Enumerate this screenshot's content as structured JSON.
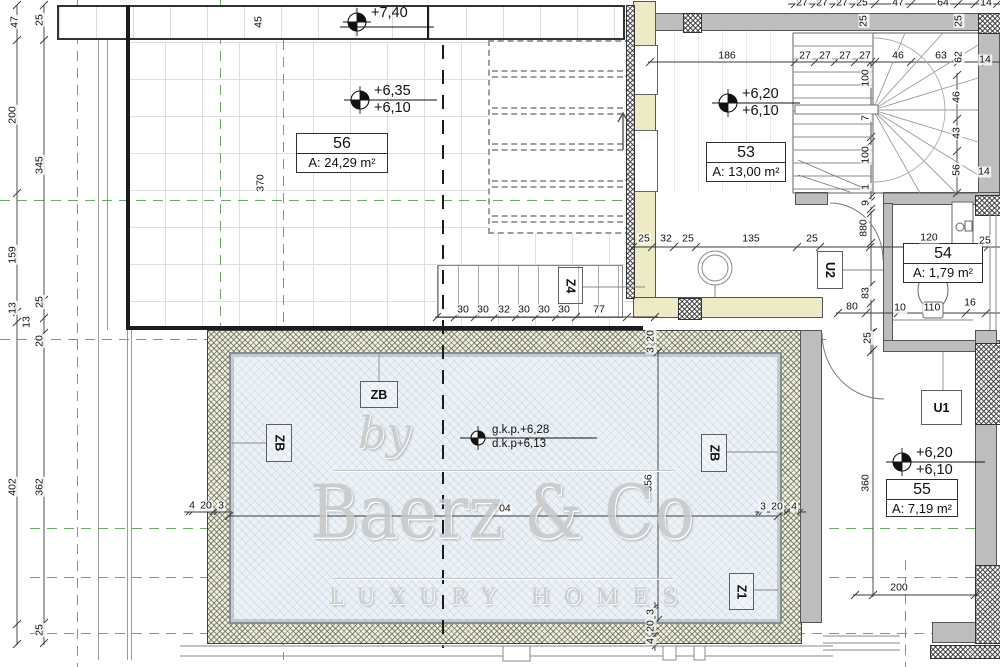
{
  "watermark": {
    "by": "by",
    "brand": "Baerz & Co",
    "tagline": "LUXURY HOMES"
  },
  "rooms": [
    {
      "number": "56",
      "area": "A: 24,29 m²"
    },
    {
      "number": "53",
      "area": "A: 13,00 m²"
    },
    {
      "number": "54",
      "area": "A: 1,79 m²"
    },
    {
      "number": "55",
      "area": "A: 7,19 m²"
    }
  ],
  "zone_labels": [
    {
      "t": "ZB",
      "x": 266,
      "y": 424,
      "w": 26,
      "h": 38,
      "rot": 1
    },
    {
      "t": "ZB",
      "x": 360,
      "y": 381,
      "w": 38,
      "h": 27,
      "rot": 0
    },
    {
      "t": "ZB",
      "x": 701,
      "y": 434,
      "w": 26,
      "h": 38,
      "rot": 1
    },
    {
      "t": "Z4",
      "x": 558,
      "y": 267,
      "w": 25,
      "h": 37,
      "rot": 1
    },
    {
      "t": "Z1",
      "x": 729,
      "y": 573,
      "w": 25,
      "h": 37,
      "rot": 1
    },
    {
      "t": "U1",
      "x": 921,
      "y": 390,
      "w": 41,
      "h": 35,
      "rot": 0
    },
    {
      "t": "U2",
      "x": 817,
      "y": 251,
      "w": 26,
      "h": 38,
      "rot": 1
    }
  ],
  "level_markers": [
    {
      "x": 357,
      "y": 22,
      "small": 0,
      "lines": [
        "+7,40"
      ]
    },
    {
      "x": 360,
      "y": 100,
      "small": 0,
      "lines": [
        "+6,35",
        "+6,10"
      ]
    },
    {
      "x": 728,
      "y": 103,
      "small": 0,
      "lines": [
        "+6,20",
        "+6,10"
      ]
    },
    {
      "x": 902,
      "y": 462,
      "small": 0,
      "lines": [
        "+6,20",
        "+6,10"
      ]
    },
    {
      "x": 478,
      "y": 438,
      "small": 1,
      "lines": [
        "g.k.p.+6,28",
        "d.k.p+6,13"
      ]
    }
  ],
  "dim_labels": [
    {
      "t": "47",
      "x": 15,
      "y": 22,
      "r": 1
    },
    {
      "t": "200",
      "x": 13,
      "y": 115,
      "r": 1
    },
    {
      "t": "159",
      "x": 13,
      "y": 255,
      "r": 1
    },
    {
      "t": "13",
      "x": 13,
      "y": 308,
      "r": 1
    },
    {
      "t": "402",
      "x": 13,
      "y": 487,
      "r": 1
    },
    {
      "t": "25",
      "x": 40,
      "y": 20,
      "r": 1
    },
    {
      "t": "345",
      "x": 40,
      "y": 165,
      "r": 1
    },
    {
      "t": "25",
      "x": 40,
      "y": 302,
      "r": 1
    },
    {
      "t": "13",
      "x": 27,
      "y": 322,
      "r": 1
    },
    {
      "t": "20",
      "x": 40,
      "y": 341,
      "r": 1
    },
    {
      "t": "362",
      "x": 40,
      "y": 487,
      "r": 1
    },
    {
      "t": "25",
      "x": 40,
      "y": 630,
      "r": 1
    },
    {
      "t": "45",
      "x": 259,
      "y": 22,
      "r": 1
    },
    {
      "t": "370",
      "x": 261,
      "y": 183,
      "r": 1
    },
    {
      "t": "27",
      "x": 802,
      "y": 3,
      "r": 0
    },
    {
      "t": "27",
      "x": 822,
      "y": 3,
      "r": 0
    },
    {
      "t": "27",
      "x": 842,
      "y": 3,
      "r": 0
    },
    {
      "t": "25",
      "x": 862,
      "y": 3,
      "r": 0
    },
    {
      "t": "47",
      "x": 898,
      "y": 3,
      "r": 0
    },
    {
      "t": "64",
      "x": 943,
      "y": 3,
      "r": 0
    },
    {
      "t": "14",
      "x": 986,
      "y": 3,
      "r": 0
    },
    {
      "t": "25",
      "x": 864,
      "y": 21,
      "r": 1
    },
    {
      "t": "25",
      "x": 959,
      "y": 21,
      "r": 1
    },
    {
      "t": "186",
      "x": 727,
      "y": 56,
      "r": 0
    },
    {
      "t": "27",
      "x": 805,
      "y": 56,
      "r": 0
    },
    {
      "t": "27",
      "x": 825,
      "y": 56,
      "r": 0
    },
    {
      "t": "27",
      "x": 845,
      "y": 56,
      "r": 0
    },
    {
      "t": "27",
      "x": 865,
      "y": 56,
      "r": 0
    },
    {
      "t": "46",
      "x": 898,
      "y": 56,
      "r": 0
    },
    {
      "t": "63",
      "x": 941,
      "y": 56,
      "r": 0
    },
    {
      "t": "62",
      "x": 959,
      "y": 57,
      "r": 1
    },
    {
      "t": "14",
      "x": 985,
      "y": 60,
      "r": 0
    },
    {
      "t": "100",
      "x": 866,
      "y": 78,
      "r": 1
    },
    {
      "t": "7",
      "x": 866,
      "y": 118,
      "r": 1
    },
    {
      "t": "100",
      "x": 866,
      "y": 155,
      "r": 1
    },
    {
      "t": "1",
      "x": 866,
      "y": 187,
      "r": 1
    },
    {
      "t": "9",
      "x": 866,
      "y": 203,
      "r": 1
    },
    {
      "t": "46",
      "x": 957,
      "y": 97,
      "r": 1
    },
    {
      "t": "43",
      "x": 957,
      "y": 133,
      "r": 1
    },
    {
      "t": "56",
      "x": 957,
      "y": 170,
      "r": 1
    },
    {
      "t": "14",
      "x": 984,
      "y": 172,
      "r": 0
    },
    {
      "t": "880",
      "x": 864,
      "y": 228,
      "r": 1
    },
    {
      "t": "83",
      "x": 866,
      "y": 293,
      "r": 1
    },
    {
      "t": "80",
      "x": 852,
      "y": 307,
      "r": 0
    },
    {
      "t": "10",
      "x": 900,
      "y": 308,
      "r": 0
    },
    {
      "t": "110",
      "x": 932,
      "y": 308,
      "r": 0
    },
    {
      "t": "16",
      "x": 970,
      "y": 303,
      "r": 0
    },
    {
      "t": "25",
      "x": 868,
      "y": 338,
      "r": 1
    },
    {
      "t": "120",
      "x": 929,
      "y": 238,
      "r": 0
    },
    {
      "t": "25",
      "x": 985,
      "y": 241,
      "r": 0
    },
    {
      "t": "25",
      "x": 644,
      "y": 239,
      "r": 0
    },
    {
      "t": "32",
      "x": 666,
      "y": 239,
      "r": 0
    },
    {
      "t": "25",
      "x": 688,
      "y": 239,
      "r": 0
    },
    {
      "t": "135",
      "x": 751,
      "y": 239,
      "r": 0
    },
    {
      "t": "25",
      "x": 812,
      "y": 239,
      "r": 0
    },
    {
      "t": "30",
      "x": 463,
      "y": 310,
      "r": 0
    },
    {
      "t": "30",
      "x": 483,
      "y": 310,
      "r": 0
    },
    {
      "t": "32",
      "x": 504,
      "y": 310,
      "r": 0
    },
    {
      "t": "30",
      "x": 524,
      "y": 310,
      "r": 0
    },
    {
      "t": "30",
      "x": 544,
      "y": 310,
      "r": 0
    },
    {
      "t": "30",
      "x": 564,
      "y": 310,
      "r": 0
    },
    {
      "t": "77",
      "x": 599,
      "y": 310,
      "r": 0
    },
    {
      "t": "704",
      "x": 502,
      "y": 509,
      "r": 0
    },
    {
      "t": "356",
      "x": 649,
      "y": 483,
      "r": 1
    },
    {
      "t": "20",
      "x": 651,
      "y": 336,
      "r": 1
    },
    {
      "t": "3",
      "x": 651,
      "y": 350,
      "r": 1
    },
    {
      "t": "4",
      "x": 192,
      "y": 506,
      "r": 0
    },
    {
      "t": "20",
      "x": 206,
      "y": 506,
      "r": 0
    },
    {
      "t": "3",
      "x": 221,
      "y": 506,
      "r": 0
    },
    {
      "t": "3",
      "x": 763,
      "y": 507,
      "r": 0
    },
    {
      "t": "20",
      "x": 777,
      "y": 507,
      "r": 0
    },
    {
      "t": "4",
      "x": 794,
      "y": 507,
      "r": 0
    },
    {
      "t": "4",
      "x": 651,
      "y": 641,
      "r": 1
    },
    {
      "t": "20",
      "x": 651,
      "y": 626,
      "r": 1
    },
    {
      "t": "3",
      "x": 651,
      "y": 612,
      "r": 1
    },
    {
      "t": "360",
      "x": 866,
      "y": 483,
      "r": 1
    },
    {
      "t": "200",
      "x": 899,
      "y": 588,
      "r": 0
    }
  ],
  "colors": {
    "grid_green": "#69a869",
    "wall_gray": "#bdbdbd",
    "wall_cream": "#ecebc6",
    "pool_fill": "#edf2f7",
    "line_dark": "#333333"
  }
}
